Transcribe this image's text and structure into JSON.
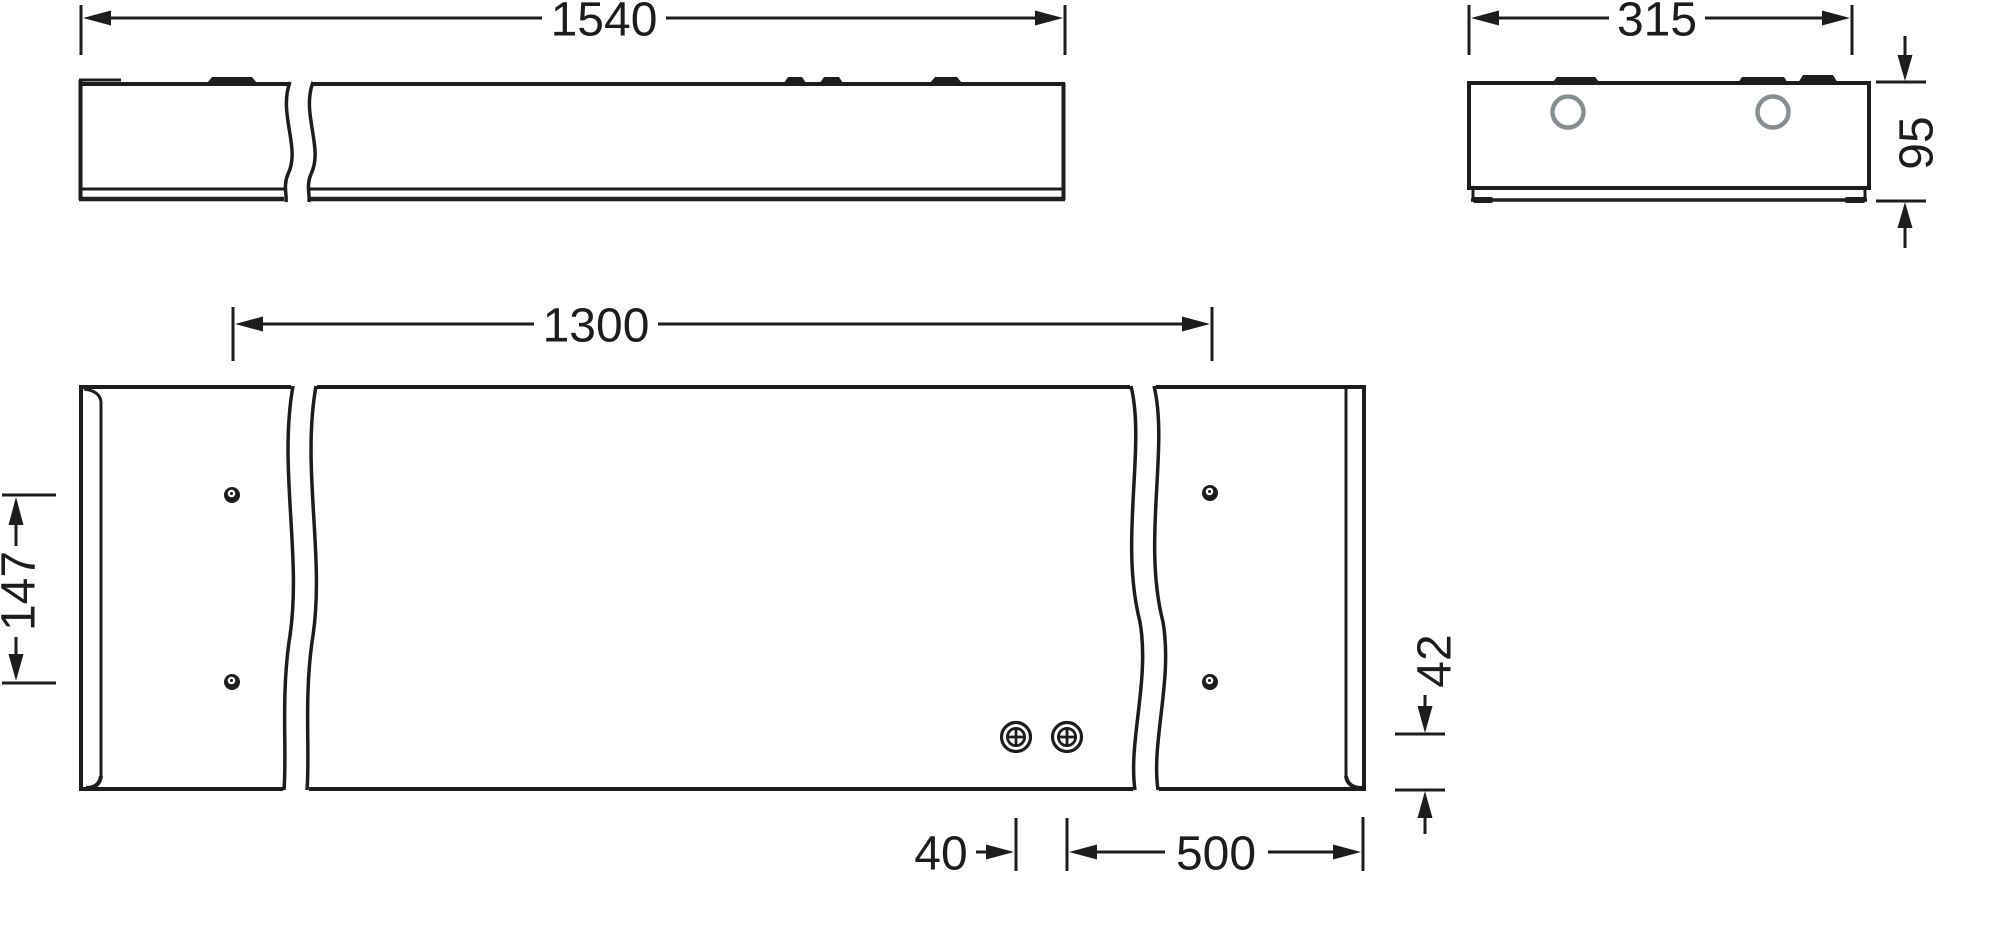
{
  "drawing": {
    "type": "technical-dimension-drawing",
    "units": "mm",
    "colors": {
      "line": "#1d1d1b",
      "mounting_hole_circle": "#868e92",
      "background": "#ffffff"
    },
    "views": {
      "side": {
        "label": "side view",
        "length_label": "1540"
      },
      "end": {
        "label": "end view",
        "width_label": "315",
        "height_label": "95"
      },
      "bottom": {
        "label": "bottom view",
        "span_label": "1300",
        "left_offset_label": "147",
        "corner_offset_label": "42",
        "screw_gap_label": "40",
        "screw_to_end_label": "500"
      }
    }
  }
}
